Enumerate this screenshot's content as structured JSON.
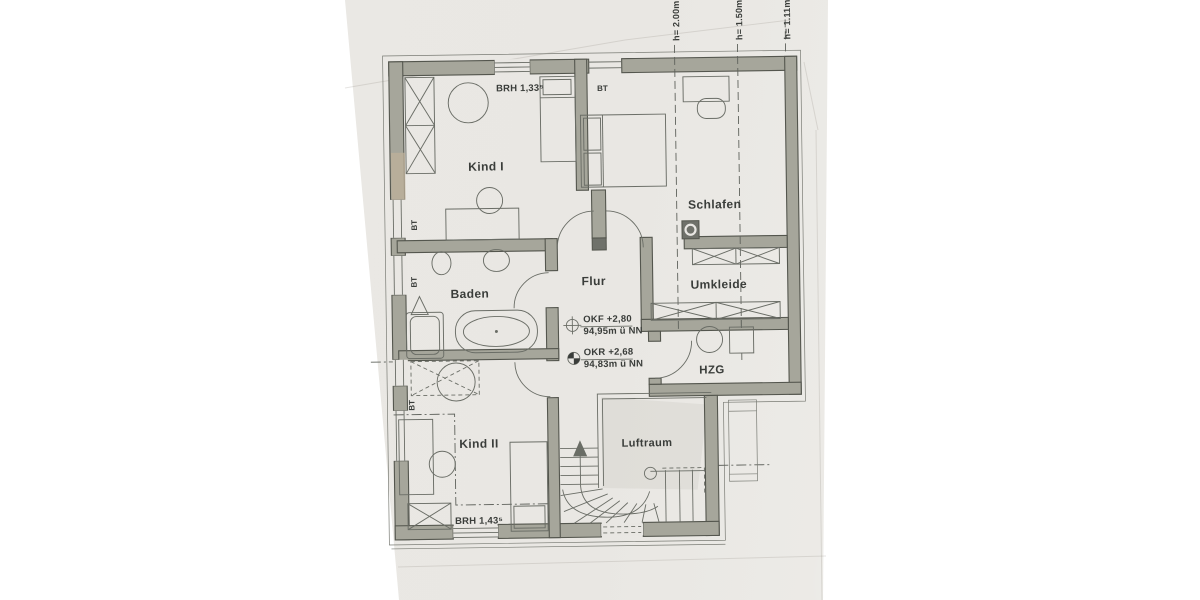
{
  "labels": {
    "kind1": "Kind I",
    "kind2": "Kind II",
    "schlafen": "Schlafen",
    "baden": "Baden",
    "flur": "Flur",
    "umkleide": "Umkleide",
    "hzg": "HZG",
    "luftraum": "Luftraum",
    "bt": "BT",
    "brh_kind1": "BRH 1,33⁵",
    "brh_kind2": "BRH 1,43⁵",
    "okf_value": "OKF +2,80",
    "okf_datum": "94,95m ü NN",
    "okr_value": "OKR +2,68",
    "okr_datum": "94,83m ü NN",
    "h1": "h= 2.00m",
    "h2": "h= 1.50m",
    "h3": "h= 1.11m"
  },
  "colors": {
    "background": "#ffffff",
    "paper": "#e9e7e3",
    "wall_fill": "#a6a69b",
    "wall_outline": "#54564e",
    "drawing_line": "#6a6d66",
    "text": "#3a3d3a"
  }
}
